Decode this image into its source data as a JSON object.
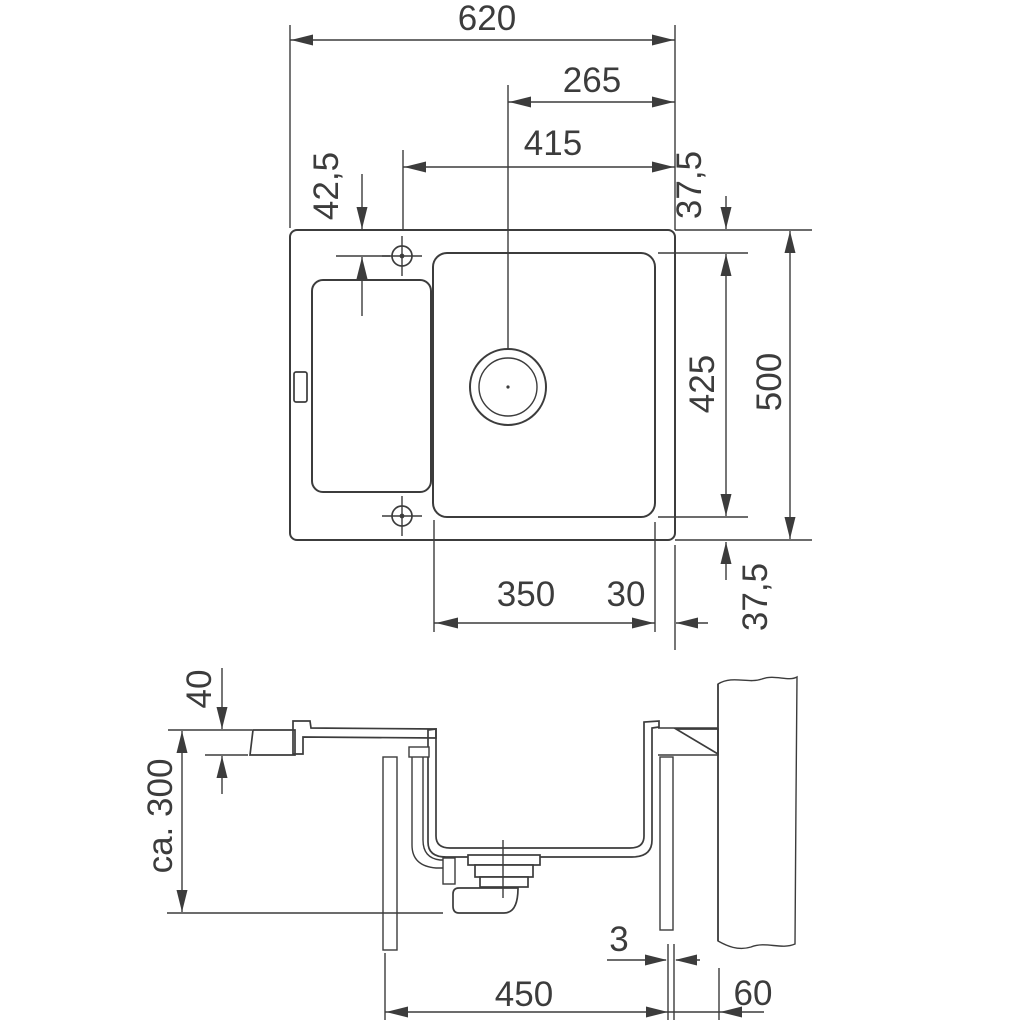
{
  "drawing": {
    "subject": "kitchen-sink-installation-dimension-drawing",
    "colors": {
      "line": "#3c3c3c",
      "background": "#ffffff"
    },
    "dims": {
      "total_width": "620",
      "drain_offset": "265",
      "taphole_offset": "415",
      "taphole_front_offset": "42,5",
      "rim_top": "37,5",
      "bowl_depth_span": "425",
      "total_depth": "500",
      "rim_bottom": "37,5",
      "bowl_width": "350",
      "rim_right": "30",
      "countertop_thickness": "40",
      "cabinet_height": "ca. 300",
      "panel_gap": "3",
      "cabinet_width": "450",
      "wall_offset": "60"
    }
  }
}
